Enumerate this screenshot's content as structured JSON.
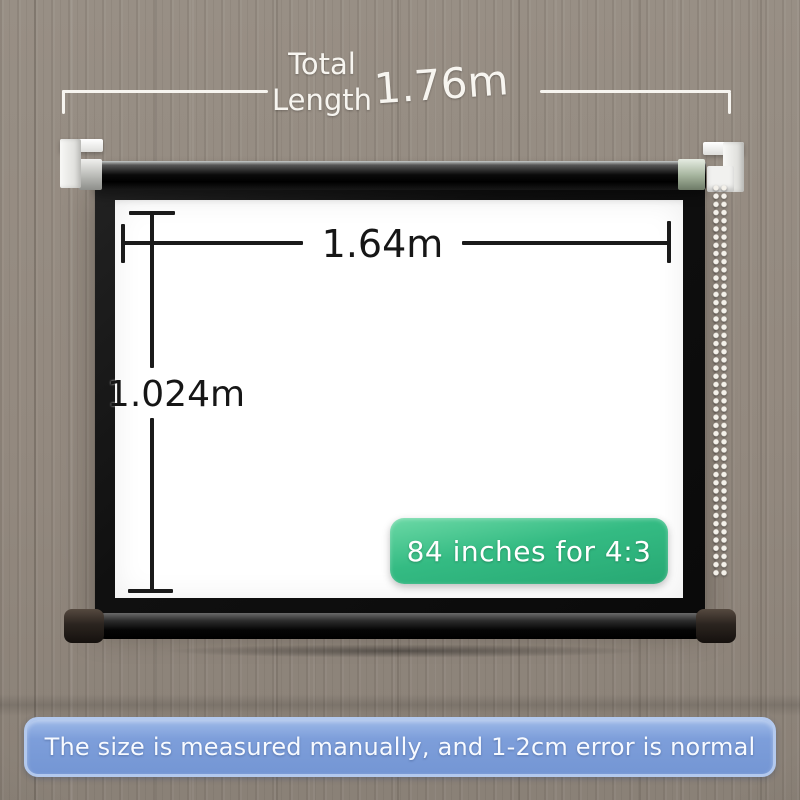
{
  "colors": {
    "wall_wood": "#91887e",
    "badge_green_top": "#6cd9a6",
    "badge_green_bottom": "#27a873",
    "banner_blue": "#7b9cd9",
    "banner_border": "#b3c9ee",
    "annotation_white": "#f7f5f0",
    "dimension_black": "#1a1a1a"
  },
  "annotations": {
    "total_length": {
      "label_line1": "Total",
      "label_line2": "Length",
      "value": "1.76m"
    },
    "screen_width": {
      "value": "1.64m"
    },
    "screen_height": {
      "value": "1.024m"
    },
    "size_badge": {
      "text": "84 inches for 4:3"
    }
  },
  "disclaimer": {
    "text": "The size is measured manually, and 1-2cm error is normal"
  }
}
